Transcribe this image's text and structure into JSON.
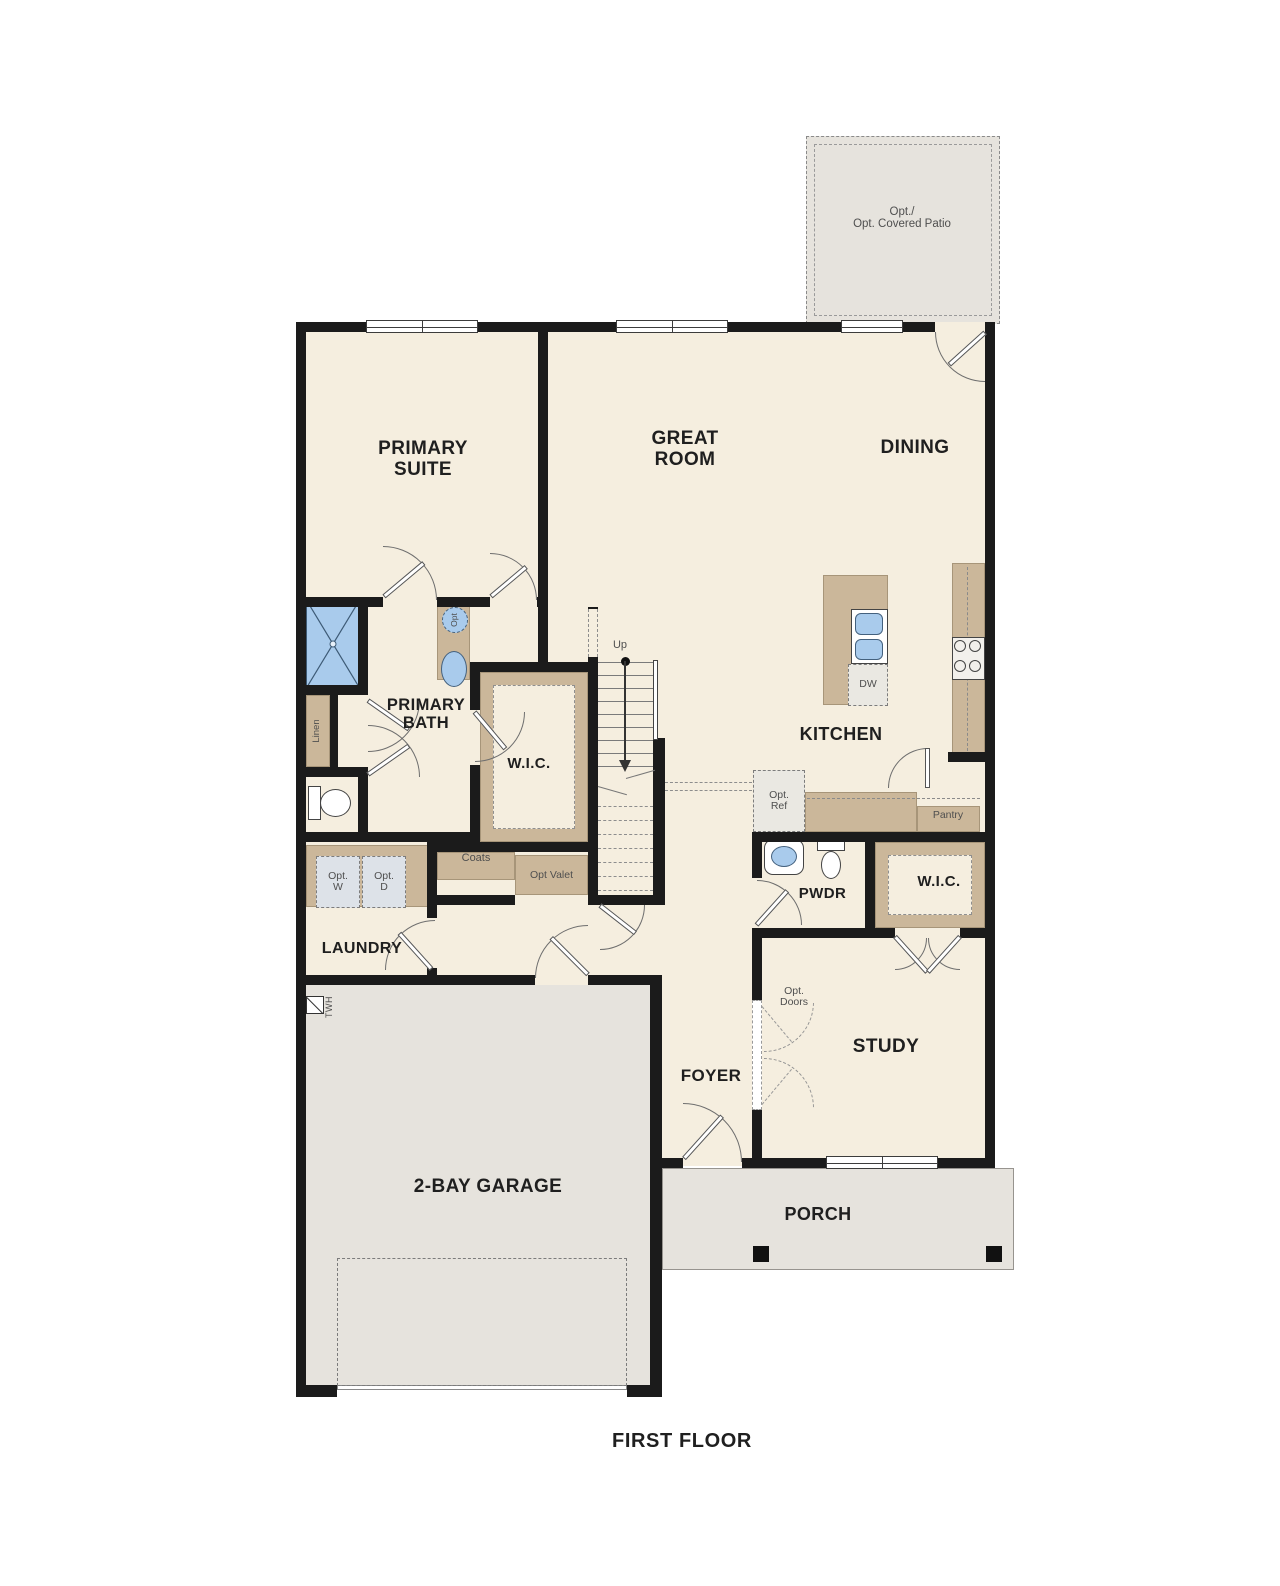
{
  "title": "FIRST FLOOR",
  "colors": {
    "wall": "#1b1b1b",
    "cream": "#f5eedf",
    "tan": "#cbb79a",
    "gray": "#e6e3dd",
    "blue": "#a9cbec",
    "box_blue": "#dde2e8",
    "box_gray": "#eae8e2",
    "dash": "#8a8a8a",
    "text": "#1f1f1f",
    "text_soft": "#4f4f4f"
  },
  "rooms": {
    "primary_suite": "PRIMARY\nSUITE",
    "great_room": "GREAT\nROOM",
    "dining": "DINING",
    "kitchen": "KITCHEN",
    "primary_bath": "PRIMARY\nBATH",
    "wic_primary": "W.I.C.",
    "wic_study": "W.I.C.",
    "laundry": "LAUNDRY",
    "pwdr": "PWDR",
    "foyer": "FOYER",
    "study": "STUDY",
    "garage": "2-BAY GARAGE",
    "porch": "PORCH",
    "patio": "Opt./\nOpt. Covered Patio"
  },
  "notes": {
    "up": "Up",
    "dw": "DW",
    "opt_ref": "Opt.\nRef",
    "pantry": "Pantry",
    "coats": "Coats",
    "opt_valet": "Opt Valet",
    "opt_w": "Opt.\nW",
    "opt_d": "Opt.\nD",
    "opt_doors": "Opt.\nDoors",
    "linen": "Linen",
    "twh": "TWH",
    "opt_sink": "Opt"
  }
}
